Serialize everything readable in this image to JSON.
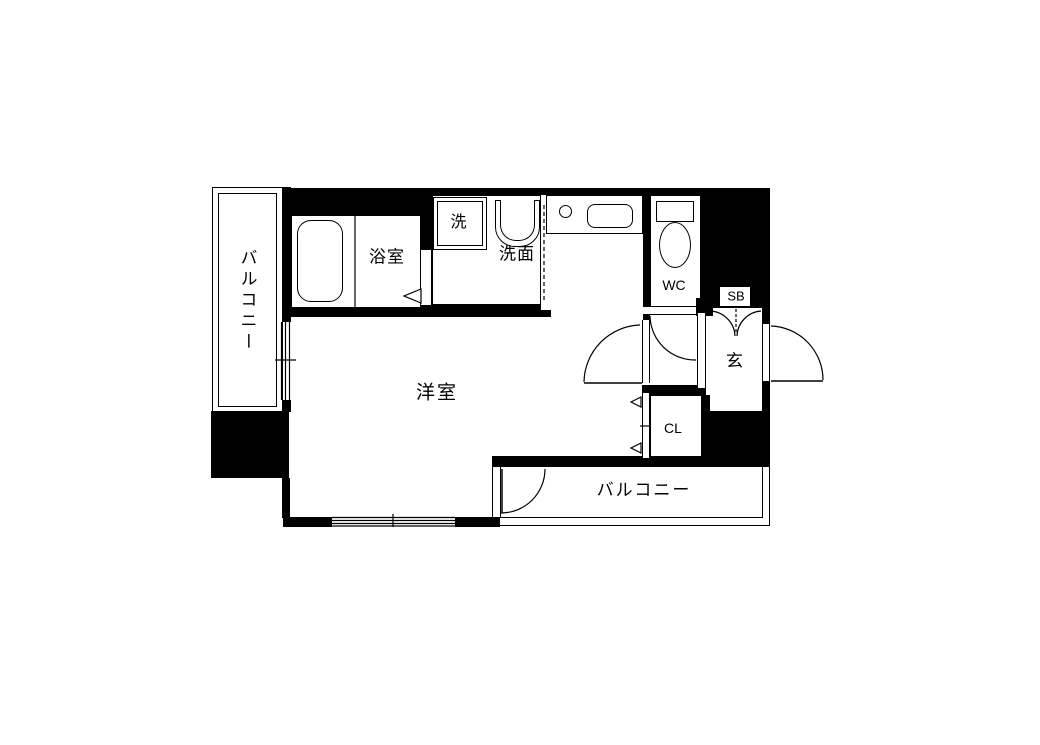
{
  "title": "apartment-floor-plan",
  "colors": {
    "wall": "#000000",
    "floor": "#ffffff",
    "line": "#000000"
  },
  "rooms": {
    "balcony_left": {
      "label": "バルコニー"
    },
    "bathroom": {
      "label": "浴室"
    },
    "washer": {
      "label": "洗"
    },
    "washroom": {
      "label": "洗面"
    },
    "wc": {
      "label": "WC"
    },
    "shoe_box": {
      "label": "SB"
    },
    "entrance": {
      "label": "玄"
    },
    "closet": {
      "label": "CL"
    },
    "western_room": {
      "label": "洋室"
    },
    "balcony_bottom": {
      "label": "バルコニー"
    }
  }
}
